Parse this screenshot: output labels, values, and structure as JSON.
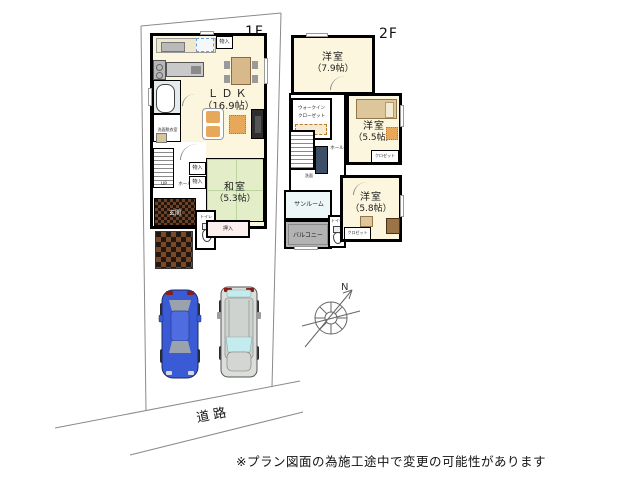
{
  "labels": {
    "floor1": "1F",
    "floor2": "2F",
    "road": "道路",
    "north": "N",
    "disclaimer": "※プラン図面の為施工途中で変更の可能性があります"
  },
  "floor1": {
    "ldk_name": "ＬＤＫ",
    "ldk_size": "（16.9帖）",
    "washitsu_name": "和室",
    "washitsu_size": "（5.3帖）",
    "genkan": "玄関",
    "hall": "ホール",
    "stairs_up": "UP",
    "washroom": "洗面脱衣室",
    "toilet": "トイレ",
    "storage_top": "物入",
    "storage_a": "物入",
    "storage_b": "物入",
    "oshiire": "押入"
  },
  "floor2": {
    "room79_name": "洋室",
    "room79_size": "（7.9帖）",
    "room55_name": "洋室",
    "room55_size": "（5.5帖）",
    "room58_name": "洋室",
    "room58_size": "（5.8帖）",
    "wic_line1": "ウォークイン",
    "wic_line2": "クローゼット",
    "hall": "ホール",
    "washbasin": "洗面",
    "sunroom": "サンルーム",
    "balcony": "バルコニー",
    "toilet": "トイレ",
    "closet55": "クロゼット",
    "closet58": "クロゼット"
  },
  "colors": {
    "wall": "#000000",
    "floor_cream": "#fbf6dd",
    "tatami_green": "#e3eec9",
    "balcony_gray": "#b3b3b3",
    "car_blue": "#3b5bd6",
    "car_silver": "#dcdedb",
    "wood_accent": "#d8b98c"
  }
}
